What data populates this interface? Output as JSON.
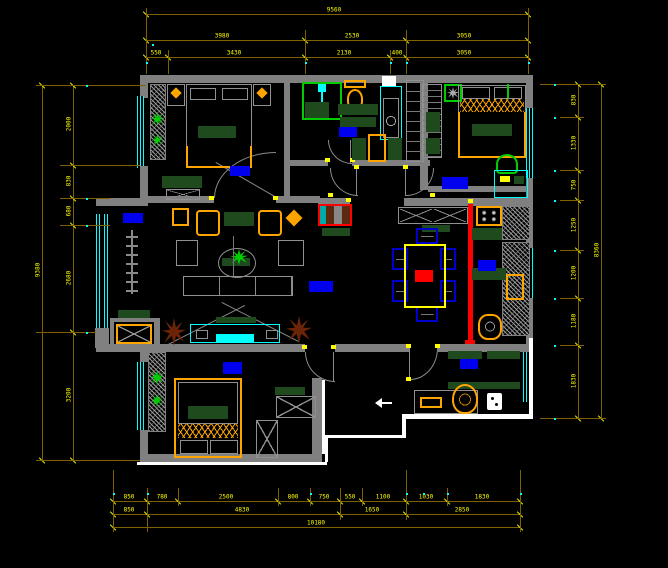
{
  "title": "apartment-floor-plan-cad-drawing",
  "palette": {
    "wall": "#808080",
    "wall_highlight": "#ffffff",
    "window": "#00ffff",
    "dimension_line": "#7f6000",
    "dimension_text": "#ffff00",
    "label": "#0000ee",
    "furniture": "#ffa500",
    "accent_red": "#ff0000",
    "greenery": "#00cc00",
    "dark_green": "#1e4a1e",
    "chair_blue": "#0000cc",
    "plant_brown": "#6b2408"
  },
  "rooms": [
    {
      "name": "主卧",
      "x": 230,
      "y": 166,
      "w": 20,
      "h": 10
    },
    {
      "name": "卫生间",
      "x": 339,
      "y": 127,
      "w": 18,
      "h": 10
    },
    {
      "name": "次卧",
      "x": 442,
      "y": 177,
      "w": 26,
      "h": 12
    },
    {
      "name": "阳台",
      "x": 123,
      "y": 213,
      "w": 20,
      "h": 10
    },
    {
      "name": "客厅",
      "x": 309,
      "y": 281,
      "w": 24,
      "h": 11
    },
    {
      "name": "厨房",
      "x": 478,
      "y": 260,
      "w": 18,
      "h": 11
    },
    {
      "name": "卧室",
      "x": 223,
      "y": 362,
      "w": 19,
      "h": 12
    },
    {
      "name": "玄关",
      "x": 460,
      "y": 359,
      "w": 18,
      "h": 10
    }
  ],
  "dimensions": {
    "horizontal": [
      {
        "y": 14,
        "x1": 146,
        "x2": 528,
        "ticks": [
          146,
          528
        ],
        "labels": [
          {
            "t": "9560",
            "x": 334
          }
        ]
      },
      {
        "y": 40,
        "x1": 146,
        "x2": 528,
        "ticks": [
          146,
          305,
          406,
          528
        ],
        "labels": [
          {
            "t": "3980",
            "x": 222
          },
          {
            "t": "2530",
            "x": 352
          },
          {
            "t": "3050",
            "x": 464
          }
        ]
      },
      {
        "y": 57,
        "x1": 146,
        "x2": 528,
        "ticks": [
          146,
          168,
          305,
          390,
          406,
          528
        ],
        "labels": [
          {
            "t": "550",
            "x": 156
          },
          {
            "t": "3430",
            "x": 234
          },
          {
            "t": "2130",
            "x": 344
          },
          {
            "t": "400",
            "x": 397
          },
          {
            "t": "3050",
            "x": 464
          }
        ]
      },
      {
        "y": 501,
        "x1": 113,
        "x2": 520,
        "ticks": [
          113,
          147,
          178,
          278,
          310,
          340,
          362,
          406,
          447,
          520
        ],
        "labels": [
          {
            "t": "850",
            "x": 129
          },
          {
            "t": "780",
            "x": 162
          },
          {
            "t": "2500",
            "x": 226
          },
          {
            "t": "800",
            "x": 293
          },
          {
            "t": "750",
            "x": 324
          },
          {
            "t": "550",
            "x": 350
          },
          {
            "t": "1100",
            "x": 383
          },
          {
            "t": "1030",
            "x": 426
          },
          {
            "t": "1830",
            "x": 482
          }
        ]
      },
      {
        "y": 514,
        "x1": 113,
        "x2": 520,
        "ticks": [
          113,
          147,
          340,
          406,
          520
        ],
        "labels": [
          {
            "t": "850",
            "x": 129
          },
          {
            "t": "4830",
            "x": 242
          },
          {
            "t": "1650",
            "x": 372
          },
          {
            "t": "2850",
            "x": 462
          }
        ]
      },
      {
        "y": 527,
        "x1": 113,
        "x2": 520,
        "ticks": [
          113,
          520
        ],
        "labels": [
          {
            "t": "10180",
            "x": 316
          }
        ]
      }
    ],
    "vertical": [
      {
        "x": 42,
        "y1": 85,
        "y2": 460,
        "ticks": [
          85,
          460
        ],
        "labels": [
          {
            "t": "9380",
            "y": 270
          }
        ]
      },
      {
        "x": 73,
        "y1": 85,
        "y2": 460,
        "ticks": [
          85,
          165,
          198,
          225,
          332,
          460
        ],
        "labels": [
          {
            "t": "2000",
            "y": 124
          },
          {
            "t": "830",
            "y": 181
          },
          {
            "t": "680",
            "y": 211
          },
          {
            "t": "2680",
            "y": 278
          },
          {
            "t": "3200",
            "y": 395
          }
        ]
      },
      {
        "x": 578,
        "y1": 84,
        "y2": 418,
        "ticks": [
          84,
          117,
          170,
          200,
          250,
          298,
          345,
          418
        ],
        "labels": [
          {
            "t": "830",
            "y": 100
          },
          {
            "t": "1330",
            "y": 143
          },
          {
            "t": "750",
            "y": 185
          },
          {
            "t": "1250",
            "y": 225
          },
          {
            "t": "1200",
            "y": 273
          },
          {
            "t": "1180",
            "y": 321
          },
          {
            "t": "1830",
            "y": 381
          }
        ]
      },
      {
        "x": 601,
        "y1": 84,
        "y2": 418,
        "ticks": [
          84,
          418
        ],
        "labels": [
          {
            "t": "8360",
            "y": 250
          }
        ]
      }
    ],
    "extensions": {
      "h": [
        {
          "y": 85,
          "x1": 36,
          "x2": 146
        },
        {
          "y": 165,
          "x1": 60,
          "x2": 140
        },
        {
          "y": 198,
          "x1": 60,
          "x2": 110
        },
        {
          "y": 225,
          "x1": 60,
          "x2": 110
        },
        {
          "y": 332,
          "x1": 36,
          "x2": 96
        },
        {
          "y": 460,
          "x1": 36,
          "x2": 140
        },
        {
          "y": 84,
          "x1": 540,
          "x2": 606
        },
        {
          "y": 117,
          "x1": 560,
          "x2": 584
        },
        {
          "y": 170,
          "x1": 560,
          "x2": 584
        },
        {
          "y": 200,
          "x1": 560,
          "x2": 584
        },
        {
          "y": 250,
          "x1": 560,
          "x2": 584
        },
        {
          "y": 298,
          "x1": 560,
          "x2": 584
        },
        {
          "y": 345,
          "x1": 560,
          "x2": 584
        },
        {
          "y": 418,
          "x1": 540,
          "x2": 606
        }
      ],
      "v": [
        {
          "x": 146,
          "y1": 8,
          "y2": 74
        },
        {
          "x": 305,
          "y1": 30,
          "y2": 74
        },
        {
          "x": 406,
          "y1": 30,
          "y2": 74
        },
        {
          "x": 528,
          "y1": 8,
          "y2": 74
        },
        {
          "x": 168,
          "y1": 50,
          "y2": 74
        },
        {
          "x": 390,
          "y1": 50,
          "y2": 74
        },
        {
          "x": 113,
          "y1": 470,
          "y2": 532
        },
        {
          "x": 147,
          "y1": 488,
          "y2": 532
        },
        {
          "x": 178,
          "y1": 488,
          "y2": 506
        },
        {
          "x": 278,
          "y1": 488,
          "y2": 506
        },
        {
          "x": 310,
          "y1": 488,
          "y2": 506
        },
        {
          "x": 340,
          "y1": 488,
          "y2": 520
        },
        {
          "x": 362,
          "y1": 488,
          "y2": 506
        },
        {
          "x": 406,
          "y1": 470,
          "y2": 520
        },
        {
          "x": 447,
          "y1": 488,
          "y2": 506
        },
        {
          "x": 520,
          "y1": 470,
          "y2": 532
        }
      ]
    },
    "dots": [
      {
        "x": 146,
        "y": 62
      },
      {
        "x": 305,
        "y": 62
      },
      {
        "x": 390,
        "y": 62
      },
      {
        "x": 406,
        "y": 62
      },
      {
        "x": 528,
        "y": 62
      },
      {
        "x": 152,
        "y": 44
      },
      {
        "x": 113,
        "y": 493
      },
      {
        "x": 147,
        "y": 493
      },
      {
        "x": 310,
        "y": 493
      },
      {
        "x": 406,
        "y": 493
      },
      {
        "x": 423,
        "y": 493
      },
      {
        "x": 447,
        "y": 493
      },
      {
        "x": 520,
        "y": 493
      },
      {
        "x": 86,
        "y": 85
      },
      {
        "x": 86,
        "y": 198
      },
      {
        "x": 86,
        "y": 225
      },
      {
        "x": 86,
        "y": 332
      },
      {
        "x": 554,
        "y": 84
      },
      {
        "x": 554,
        "y": 117
      },
      {
        "x": 554,
        "y": 170
      },
      {
        "x": 554,
        "y": 200
      },
      {
        "x": 554,
        "y": 250
      },
      {
        "x": 554,
        "y": 298
      },
      {
        "x": 554,
        "y": 345
      },
      {
        "x": 554,
        "y": 418
      }
    ]
  }
}
